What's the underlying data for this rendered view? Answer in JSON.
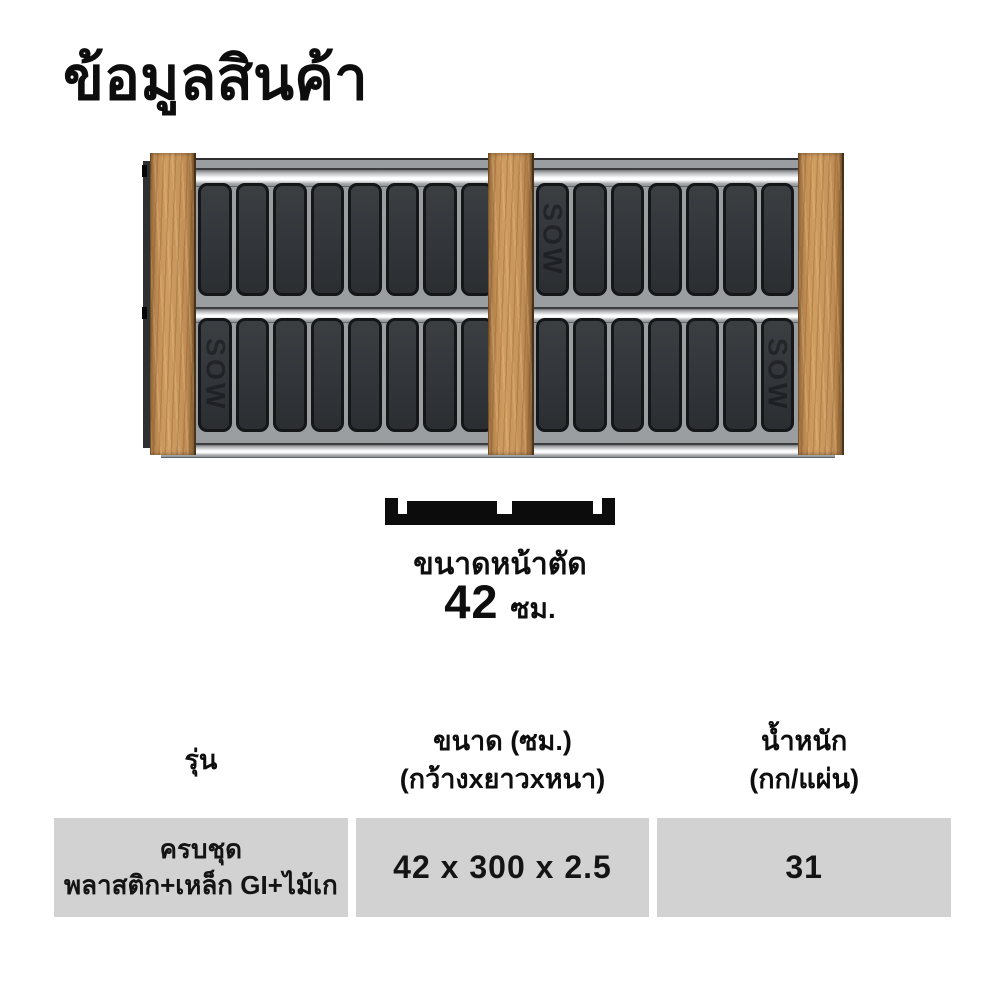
{
  "title": "ข้อมูลสินค้า",
  "product_image": {
    "brand": "SOW",
    "slats_per_row": 16
  },
  "cross_section": {
    "label": "ขนาดหน้าตัด",
    "size_value": "42",
    "size_unit": "ซม."
  },
  "table": {
    "headers": [
      {
        "line1": "รุ่น",
        "line2": ""
      },
      {
        "line1": "ขนาด (ซม.)",
        "line2": "(กว้างxยาวxหนา)"
      },
      {
        "line1": "น้ำหนัก",
        "line2": "(กก/แผ่น)"
      }
    ],
    "rows": [
      {
        "model_line1": "ครบชุด",
        "model_line2": "พลาสติก+เหล็ก GI+ไม้เก",
        "size": "42 x 300 x 2.5",
        "weight": "31"
      }
    ]
  },
  "colors": {
    "wood": "#c6945c",
    "slat_dark": "#313539",
    "panel_gray": "#9b9ea1",
    "table_cell_bg": "#d2d2d2",
    "diagram_black": "#0c0c0c",
    "text": "#101010"
  }
}
